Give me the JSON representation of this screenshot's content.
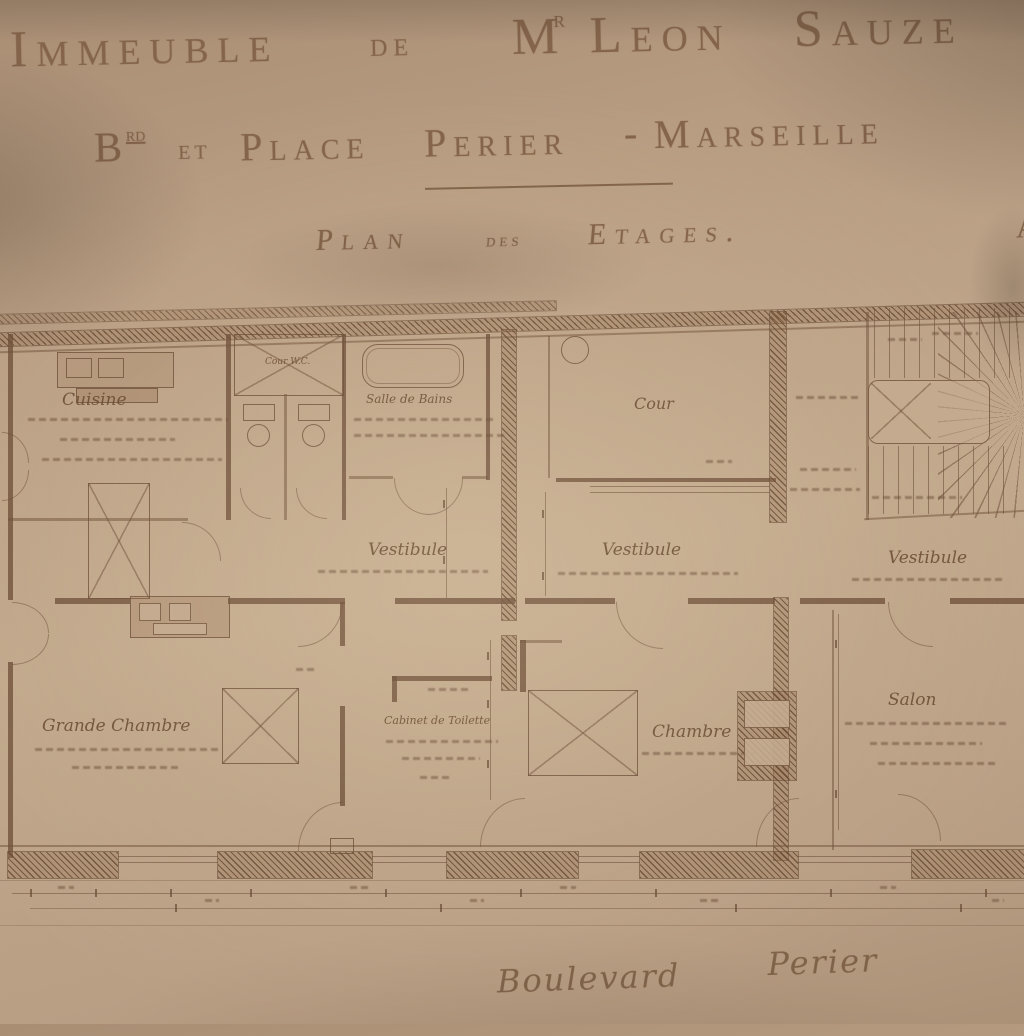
{
  "header": {
    "title": {
      "w1": "Immeuble",
      "w2": "de",
      "w3": "M",
      "w3_sup": "r",
      "w4": "Leon",
      "w5": "Sauze"
    },
    "subtitle": {
      "w1": "B",
      "w1_sup": "rd",
      "w2": "et",
      "w3": "Place",
      "w4": "Perier",
      "w5": "-",
      "w6": "Marseille"
    },
    "plan_title": {
      "w1": "Plan",
      "w2": "des",
      "w3": "Etages.",
      "partial_right": "A"
    }
  },
  "plan": {
    "rooms": {
      "cuisine": "Cuisine",
      "cour_wc": "Cour W.C.",
      "salle_de_bains": "Salle de Bains",
      "cour": "Cour",
      "vestibule_left": "Vestibule",
      "vestibule_center": "Vestibule",
      "vestibule_right": "Vestibule",
      "grande_chambre": "Grande Chambre",
      "cabinet_de_toilette": "Cabinet de Toilette",
      "chambre": "Chambre",
      "salon": "Salon"
    }
  },
  "street": {
    "w1": "Boulevard",
    "w2": "Perier"
  },
  "colors": {
    "paper": "#b79c81",
    "paper_light": "#c6ad91",
    "paper_shadow": "#9c8269",
    "ink": "#6f513a",
    "title_ink": "#84644a"
  }
}
